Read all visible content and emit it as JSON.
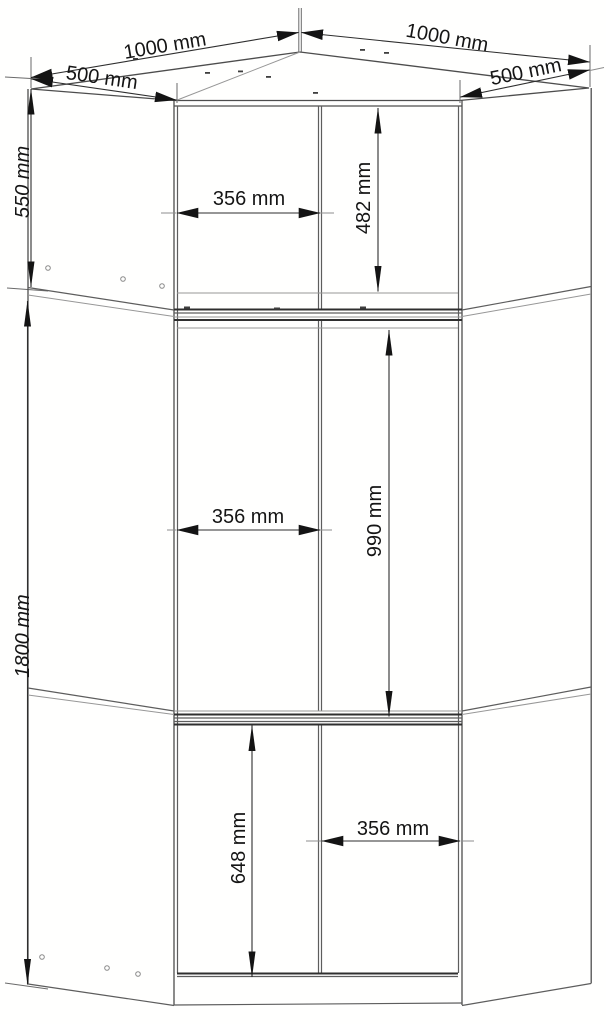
{
  "drawing": {
    "unit": "mm",
    "labels": {
      "top_left_width": "1000 mm",
      "top_right_width": "1000 mm",
      "left_side_depth": "500 mm",
      "right_side_depth": "500 mm",
      "upper_section_height": "550 mm",
      "upper_interior_height": "482 mm",
      "upper_door_width": "356 mm",
      "middle_interior_height": "990 mm",
      "middle_door_width": "356 mm",
      "total_height": "1800 mm",
      "lower_interior_height": "648 mm",
      "lower_door_width": "356 mm"
    }
  }
}
